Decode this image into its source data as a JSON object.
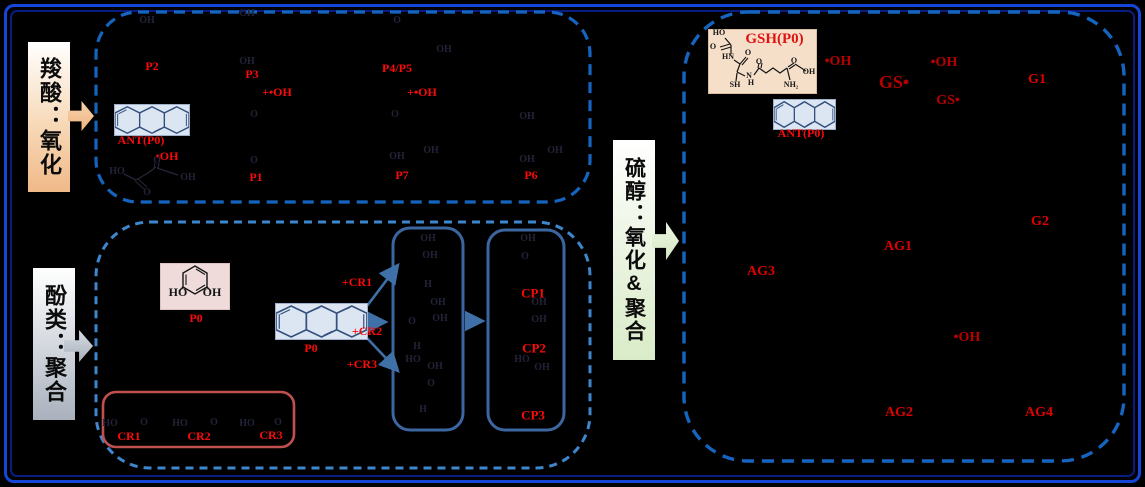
{
  "sections": {
    "carboxylic": {
      "label": "羧酸：氧化"
    },
    "phenol": {
      "label": "酚类：聚合"
    },
    "thiol": {
      "label": "硫醇：氧化&聚合"
    }
  },
  "molecules": {
    "gsh": {
      "title": "GSH(P0)"
    },
    "ant_carbox": {
      "label": "ANT(P0)"
    },
    "ant_thiol": {
      "label": "ANT(P0)"
    },
    "ant_phenol": {
      "label": "P0"
    },
    "catechol": {
      "label": "P0"
    }
  },
  "colors": {
    "frame_blue": "#1546D8",
    "panel_dash_blue": "#1565C0",
    "box_steelblue": "#3C66A0",
    "cr_box_red": "#C0504D",
    "label_red": "#FA0A0A",
    "label_darkred": "#B80000"
  },
  "floating_labels": [
    {
      "t": "P2",
      "x": 152,
      "y": 66,
      "c": "c-red",
      "n": "label-P2"
    },
    {
      "t": "P3",
      "x": 252,
      "y": 74,
      "c": "c-red",
      "n": "label-P3"
    },
    {
      "t": "P4/P5",
      "x": 397,
      "y": 68,
      "c": "c-red",
      "n": "label-P4-P5"
    },
    {
      "t": "+•OH",
      "x": 277,
      "y": 92,
      "c": "c-red",
      "n": "label-plus-oh-radical"
    },
    {
      "t": "+•OH",
      "x": 422,
      "y": 92,
      "c": "c-red",
      "n": "label-plus-oh-radical"
    },
    {
      "t": "ANT(P0)",
      "x": 141,
      "y": 140,
      "c": "c-red",
      "n": "label-ant-p0"
    },
    {
      "t": "•OH",
      "x": 167,
      "y": 156,
      "c": "c-red",
      "n": "label-oh-radical"
    },
    {
      "t": "P1",
      "x": 256,
      "y": 177,
      "c": "c-red",
      "n": "label-P1"
    },
    {
      "t": "P7",
      "x": 402,
      "y": 175,
      "c": "c-red",
      "n": "label-P7"
    },
    {
      "t": "P6",
      "x": 531,
      "y": 175,
      "c": "c-red",
      "n": "label-P6"
    },
    {
      "t": "OH",
      "x": 147,
      "y": 21,
      "c": "c-faint",
      "n": "struct-OH"
    },
    {
      "t": "OH",
      "x": 247,
      "y": 14,
      "c": "c-faint",
      "n": "struct-OH"
    },
    {
      "t": "O",
      "x": 397,
      "y": 21,
      "c": "c-faint",
      "n": "struct-O"
    },
    {
      "t": "OH",
      "x": 247,
      "y": 62,
      "c": "c-faint",
      "n": "struct-OH"
    },
    {
      "t": "OH",
      "x": 444,
      "y": 50,
      "c": "c-faint",
      "n": "struct-OH"
    },
    {
      "t": "O",
      "x": 254,
      "y": 115,
      "c": "c-faint",
      "n": "struct-O"
    },
    {
      "t": "O",
      "x": 395,
      "y": 115,
      "c": "c-faint",
      "n": "struct-O"
    },
    {
      "t": "OH",
      "x": 527,
      "y": 117,
      "c": "c-faint",
      "n": "struct-OH"
    },
    {
      "t": "O",
      "x": 254,
      "y": 161,
      "c": "c-faint",
      "n": "struct-O"
    },
    {
      "t": "OH",
      "x": 397,
      "y": 157,
      "c": "c-faint",
      "n": "struct-OH"
    },
    {
      "t": "OH",
      "x": 431,
      "y": 151,
      "c": "c-faint",
      "n": "struct-OH"
    },
    {
      "t": "OH",
      "x": 527,
      "y": 160,
      "c": "c-faint",
      "n": "struct-OH"
    },
    {
      "t": "OH",
      "x": 555,
      "y": 151,
      "c": "c-faint",
      "n": "struct-OH"
    },
    {
      "t": "HO",
      "x": 117,
      "y": 172,
      "c": "c-faint",
      "n": "struct-HO"
    },
    {
      "t": "O",
      "x": 157,
      "y": 161,
      "c": "c-faint",
      "n": "struct-O"
    },
    {
      "t": "OH",
      "x": 188,
      "y": 178,
      "c": "c-faint",
      "n": "struct-OH"
    },
    {
      "t": "O",
      "x": 147,
      "y": 193,
      "c": "c-faint",
      "n": "struct-O"
    },
    {
      "t": "P0",
      "x": 196,
      "y": 318,
      "c": "c-red",
      "n": "label-P0-catechol"
    },
    {
      "t": "P0",
      "x": 311,
      "y": 348,
      "c": "c-red",
      "n": "label-P0-ant"
    },
    {
      "t": "+CR1",
      "x": 357,
      "y": 282,
      "c": "c-red",
      "n": "label-plus-CR1"
    },
    {
      "t": "+CR2",
      "x": 367,
      "y": 331,
      "c": "c-red",
      "n": "label-plus-CR2"
    },
    {
      "t": "+CR3",
      "x": 362,
      "y": 364,
      "c": "c-red",
      "n": "label-plus-CR3"
    },
    {
      "t": "CR1",
      "x": 129,
      "y": 436,
      "c": "c-red",
      "n": "label-CR1"
    },
    {
      "t": "CR2",
      "x": 199,
      "y": 436,
      "c": "c-red",
      "n": "label-CR2"
    },
    {
      "t": "CR3",
      "x": 271,
      "y": 435,
      "c": "c-red",
      "n": "label-CR3"
    },
    {
      "t": "HO",
      "x": 110,
      "y": 424,
      "c": "c-faint",
      "n": "struct-HO"
    },
    {
      "t": "O",
      "x": 144,
      "y": 423,
      "c": "c-faint",
      "n": "struct-O"
    },
    {
      "t": "HO",
      "x": 180,
      "y": 424,
      "c": "c-faint",
      "n": "struct-HO"
    },
    {
      "t": "O",
      "x": 214,
      "y": 423,
      "c": "c-faint",
      "n": "struct-O"
    },
    {
      "t": "HO",
      "x": 247,
      "y": 424,
      "c": "c-faint",
      "n": "struct-HO"
    },
    {
      "t": "O",
      "x": 278,
      "y": 423,
      "c": "c-faint",
      "n": "struct-O"
    },
    {
      "t": "CP1",
      "x": 533,
      "y": 293,
      "c": "c-red",
      "fs": 13,
      "n": "label-CP1"
    },
    {
      "t": "CP2",
      "x": 534,
      "y": 348,
      "c": "c-red",
      "fs": 13,
      "n": "label-CP2"
    },
    {
      "t": "CP3",
      "x": 533,
      "y": 415,
      "c": "c-red",
      "fs": 13,
      "n": "label-CP3"
    },
    {
      "t": "OH",
      "x": 428,
      "y": 239,
      "c": "c-faint",
      "n": "struct-OH"
    },
    {
      "t": "OH",
      "x": 430,
      "y": 256,
      "c": "c-faint",
      "n": "struct-OH"
    },
    {
      "t": "H",
      "x": 428,
      "y": 285,
      "c": "c-faint",
      "n": "struct-H"
    },
    {
      "t": "OH",
      "x": 438,
      "y": 303,
      "c": "c-faint",
      "n": "struct-OH"
    },
    {
      "t": "O",
      "x": 412,
      "y": 322,
      "c": "c-faint",
      "n": "struct-O"
    },
    {
      "t": "OH",
      "x": 440,
      "y": 319,
      "c": "c-faint",
      "n": "struct-OH"
    },
    {
      "t": "H",
      "x": 417,
      "y": 347,
      "c": "c-faint",
      "n": "struct-H"
    },
    {
      "t": "HO",
      "x": 413,
      "y": 360,
      "c": "c-faint",
      "n": "struct-HO"
    },
    {
      "t": "OH",
      "x": 435,
      "y": 367,
      "c": "c-faint",
      "n": "struct-OH"
    },
    {
      "t": "O",
      "x": 431,
      "y": 384,
      "c": "c-faint",
      "n": "struct-O"
    },
    {
      "t": "H",
      "x": 423,
      "y": 410,
      "c": "c-faint",
      "n": "struct-H"
    },
    {
      "t": "OH",
      "x": 528,
      "y": 239,
      "c": "c-faint",
      "n": "struct-OH"
    },
    {
      "t": "O",
      "x": 525,
      "y": 257,
      "c": "c-faint",
      "n": "struct-O"
    },
    {
      "t": "OH",
      "x": 539,
      "y": 303,
      "c": "c-faint",
      "n": "struct-OH"
    },
    {
      "t": "OH",
      "x": 539,
      "y": 320,
      "c": "c-faint",
      "n": "struct-OH"
    },
    {
      "t": "HO",
      "x": 522,
      "y": 360,
      "c": "c-faint",
      "n": "struct-HO"
    },
    {
      "t": "OH",
      "x": 542,
      "y": 368,
      "c": "c-faint",
      "n": "struct-OH"
    },
    {
      "t": "•OH",
      "x": 838,
      "y": 62,
      "c": "c-dred",
      "n": "label-oh-radical"
    },
    {
      "t": "GS•",
      "x": 894,
      "y": 82,
      "c": "c-dred",
      "fs": 18,
      "n": "label-GS-radical"
    },
    {
      "t": "•OH",
      "x": 944,
      "y": 63,
      "c": "c-dred",
      "n": "label-oh-radical"
    },
    {
      "t": "GS•",
      "x": 948,
      "y": 101,
      "c": "c-dred",
      "n": "label-GS-radical"
    },
    {
      "t": "G1",
      "x": 1037,
      "y": 80,
      "c": "c-red2",
      "n": "label-G1"
    },
    {
      "t": "ANT(P0)",
      "x": 801,
      "y": 133,
      "c": "c-red",
      "n": "label-ant-p0"
    },
    {
      "t": "G2",
      "x": 1040,
      "y": 222,
      "c": "c-red2",
      "n": "label-G2"
    },
    {
      "t": "AG1",
      "x": 898,
      "y": 247,
      "c": "c-red2",
      "n": "label-AG1"
    },
    {
      "t": "AG3",
      "x": 761,
      "y": 272,
      "c": "c-red2",
      "n": "label-AG3"
    },
    {
      "t": "•OH",
      "x": 967,
      "y": 338,
      "c": "c-dred",
      "n": "label-oh-radical"
    },
    {
      "t": "AG2",
      "x": 899,
      "y": 413,
      "c": "c-red2",
      "n": "label-AG2"
    },
    {
      "t": "AG4",
      "x": 1039,
      "y": 413,
      "c": "c-red2",
      "n": "label-AG4"
    },
    {
      "t": "HO",
      "x": 719,
      "y": 33,
      "c": "c-atom",
      "n": "gsh-atom-HO"
    },
    {
      "t": "O",
      "x": 713,
      "y": 47,
      "c": "c-atom",
      "n": "gsh-atom-O"
    },
    {
      "t": "HN",
      "x": 728,
      "y": 57,
      "c": "c-atom",
      "n": "gsh-atom-HN"
    },
    {
      "t": "O",
      "x": 748,
      "y": 53,
      "c": "c-atom",
      "n": "gsh-atom-O"
    },
    {
      "t": "O",
      "x": 759,
      "y": 62,
      "c": "c-atom",
      "n": "gsh-atom-O"
    },
    {
      "t": "SH",
      "x": 735,
      "y": 85,
      "c": "c-atom",
      "n": "gsh-atom-SH"
    },
    {
      "t": "N",
      "x": 749,
      "y": 76,
      "c": "c-atom",
      "n": "gsh-atom-N"
    },
    {
      "t": "H",
      "x": 751,
      "y": 83,
      "c": "c-atom",
      "n": "gsh-atom-H"
    },
    {
      "t": "O",
      "x": 794,
      "y": 61,
      "c": "c-atom",
      "n": "gsh-atom-O"
    },
    {
      "t": "OH",
      "x": 809,
      "y": 72,
      "c": "c-atom",
      "n": "gsh-atom-OH"
    },
    {
      "t": "NH₂",
      "x": 791,
      "y": 85,
      "c": "c-atom",
      "n": "gsh-atom-NH2"
    },
    {
      "t": "HO",
      "x": 178,
      "y": 292,
      "c": "c-atomlg",
      "n": "catechol-atom-HO"
    },
    {
      "t": "OH",
      "x": 212,
      "y": 292,
      "c": "c-atomlg",
      "n": "catechol-atom-OH"
    }
  ]
}
